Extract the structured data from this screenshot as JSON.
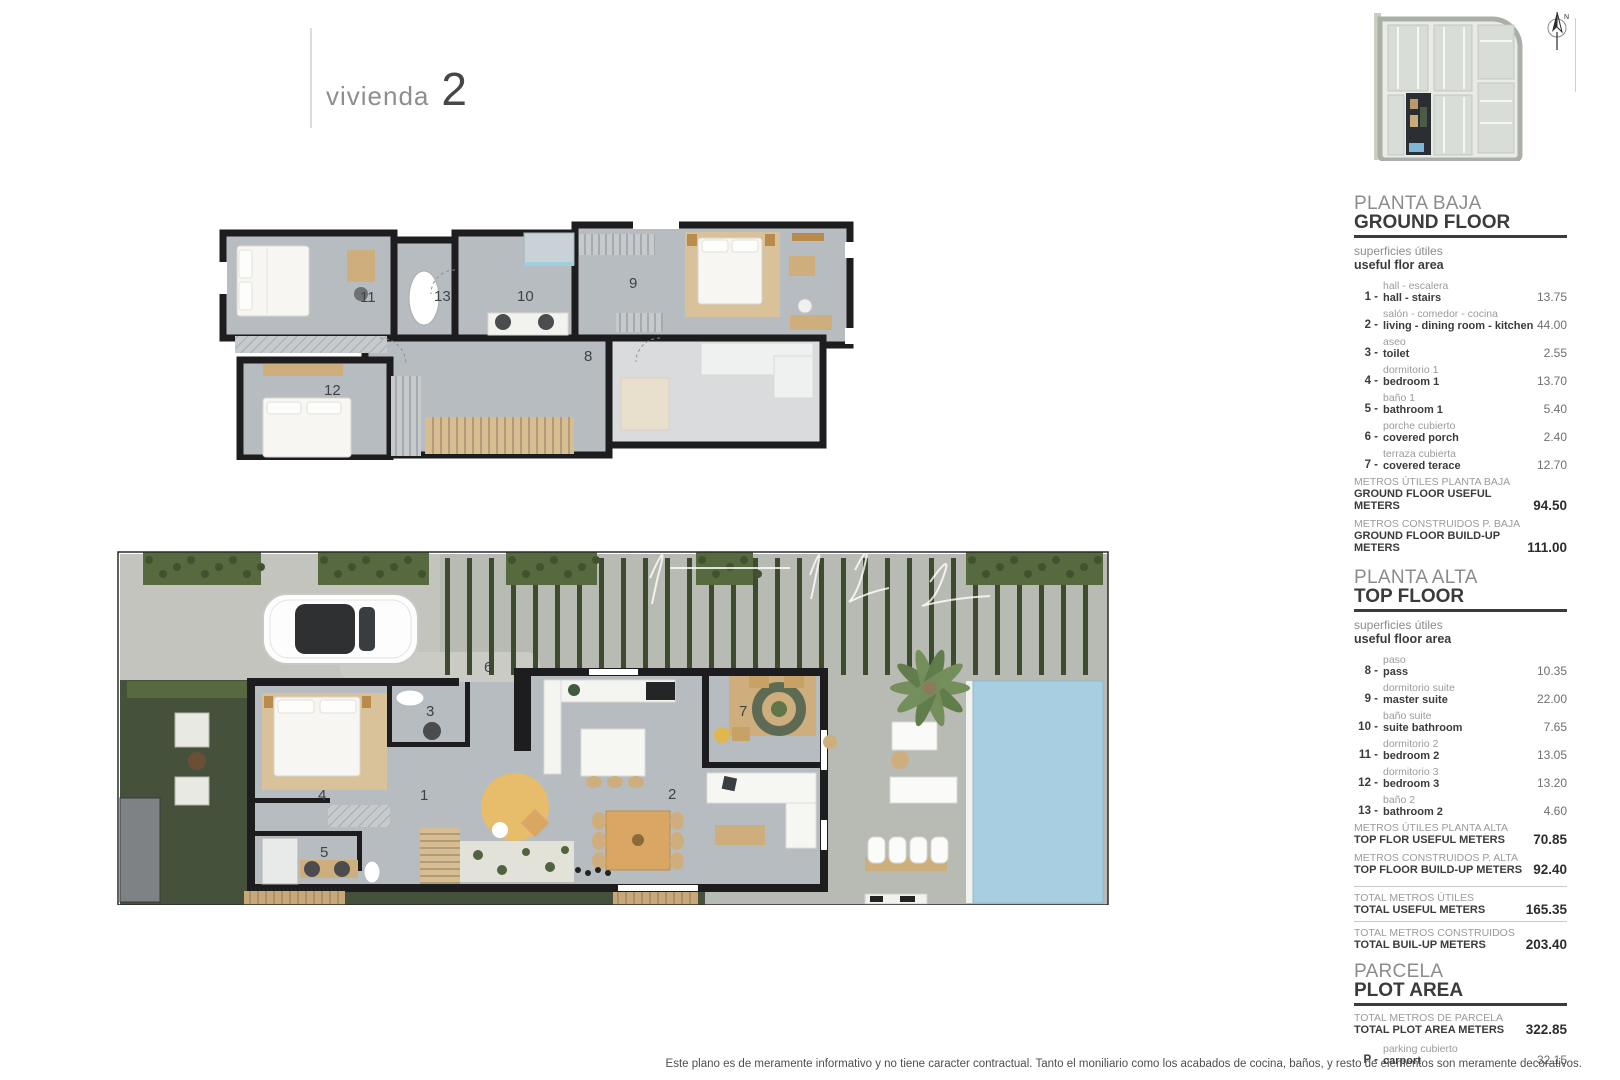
{
  "header": {
    "title_label": "vivienda",
    "title_number": "2"
  },
  "compass": {
    "north_label": "N"
  },
  "panel": {
    "sections": [
      {
        "title_es": "PLANTA BAJA",
        "title_en": "GROUND FLOOR",
        "subtitle_es": "superficies útiles",
        "subtitle_en": "useful flor area",
        "items": [
          {
            "num": "1",
            "label_es": "hall - escalera",
            "label_en": "hall - stairs",
            "value": "13.75"
          },
          {
            "num": "2",
            "label_es": "salón - comedor - cocina",
            "label_en": "living - dining room - kitchen",
            "value": "44.00"
          },
          {
            "num": "3",
            "label_es": "aseo",
            "label_en": "toilet",
            "value": "2.55"
          },
          {
            "num": "4",
            "label_es": "dormitorio 1",
            "label_en": "bedroom 1",
            "value": "13.70"
          },
          {
            "num": "5",
            "label_es": "baño 1",
            "label_en": "bathroom 1",
            "value": "5.40"
          },
          {
            "num": "6",
            "label_es": "porche cubierto",
            "label_en": "covered porch",
            "value": "2.40"
          },
          {
            "num": "7",
            "label_es": "terraza cubierta",
            "label_en": "covered terace",
            "value": "12.70"
          }
        ],
        "totals": [
          {
            "label_es": "METROS ÚTILES PLANTA BAJA",
            "label_en": "GROUND FLOOR USEFUL METERS",
            "value": "94.50"
          },
          {
            "label_es": "METROS CONSTRUIDOS P. BAJA",
            "label_en": "GROUND FLOOR BUILD-UP METERS",
            "value": "111.00"
          }
        ]
      },
      {
        "title_es": "PLANTA ALTA",
        "title_en": "TOP FLOOR",
        "subtitle_es": "superficies útiles",
        "subtitle_en": "useful floor area",
        "items": [
          {
            "num": "8",
            "label_es": "paso",
            "label_en": "pass",
            "value": "10.35"
          },
          {
            "num": "9",
            "label_es": "dormitorio suite",
            "label_en": "master suite",
            "value": "22.00"
          },
          {
            "num": "10",
            "label_es": "baño suite",
            "label_en": "suite bathroom",
            "value": "7.65"
          },
          {
            "num": "11",
            "label_es": "dormitorio 2",
            "label_en": "bedroom 2",
            "value": "13.05"
          },
          {
            "num": "12",
            "label_es": "dormitorio 3",
            "label_en": "bedroom 3",
            "value": "13.20"
          },
          {
            "num": "13",
            "label_es": "baño 2",
            "label_en": "bathroom 2",
            "value": "4.60"
          }
        ],
        "totals": [
          {
            "label_es": "METROS ÚTILES PLANTA ALTA",
            "label_en": "TOP FLOR USEFUL METERS",
            "value": "70.85"
          },
          {
            "label_es": "METROS CONSTRUIDOS P. ALTA",
            "label_en": "TOP FLOOR BUILD-UP METERS",
            "value": "92.40"
          }
        ]
      }
    ],
    "grand_totals": [
      {
        "label_es": "TOTAL METROS ÚTILES",
        "label_en": "TOTAL USEFUL METERS",
        "value": "165.35"
      },
      {
        "label_es": "TOTAL METROS CONSTRUIDOS",
        "label_en": "TOTAL BUIL-UP METERS",
        "value": "203.40"
      }
    ],
    "plot": {
      "title_es": "PARCELA",
      "title_en": "PLOT AREA",
      "total": {
        "label_es": "TOTAL METROS DE PARCELA",
        "label_en": "TOTAL PLOT AREA METERS",
        "value": "322.85"
      },
      "items": [
        {
          "num": "P",
          "label_es": "parking cubierto",
          "label_en": "carport",
          "value": "32.15"
        }
      ]
    }
  },
  "plans": {
    "top_floor": {
      "room_numbers": {
        "r8": "8",
        "r9": "9",
        "r10": "10",
        "r11": "11",
        "r12": "12",
        "r13": "13"
      }
    },
    "ground_floor": {
      "room_numbers": {
        "r1": "1",
        "r2": "2",
        "r3": "3",
        "r4": "4",
        "r5": "5",
        "r6": "6",
        "r7": "7"
      }
    }
  },
  "footer": {
    "disclaimer": "Este plano es de meramente informativo y no tiene caracter contractual. Tanto el moniliario como los acabados de cocina, baños, y resto de elementos son meramente decorativos."
  },
  "colors": {
    "wall": "#1d1d1f",
    "floor": "#b7bcc0",
    "ghost_floor": "#d9dbdd",
    "pool": "#a7cfe1",
    "grass": "#45513a",
    "hedge": "#57693f",
    "slat": "#3e4b2f",
    "wood": "#cfae7e",
    "rug": "#e7bc6a",
    "concrete": "#b8bbb3",
    "driveway": "#c2c4bd"
  }
}
